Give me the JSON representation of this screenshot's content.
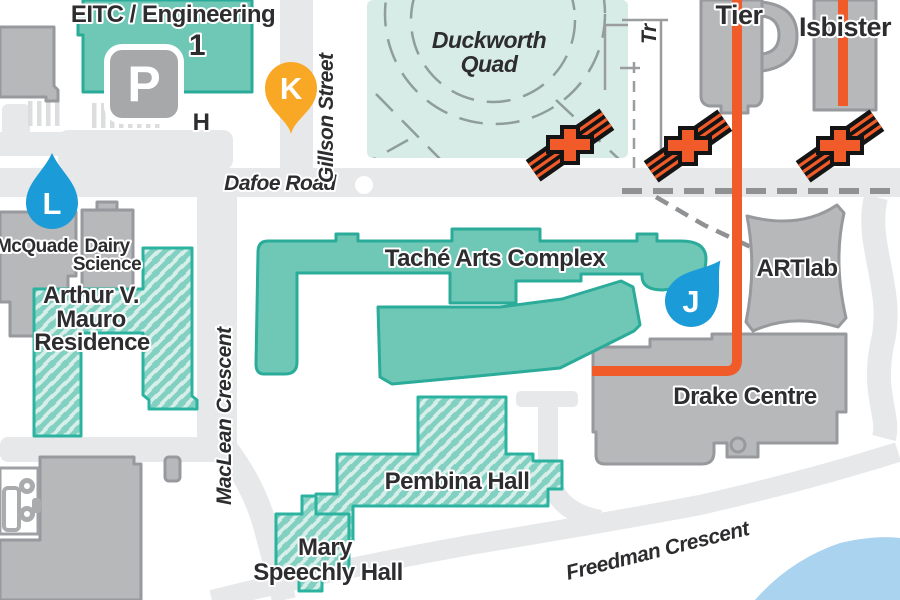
{
  "title": "Campus map",
  "colors": {
    "teal_fill": "#6FC8B6",
    "teal_stroke": "#2BAB99",
    "hatch_bg": "#D8EFE9",
    "hatch_stripe": "#82D0C2",
    "quad_fill": "#D8ECE7",
    "gray_building": "#B6B8BA",
    "gray_stroke": "#97999C",
    "road_gray": "#E7E8E9",
    "route_orange": "#F15A29",
    "pin_yellow": "#F9A825",
    "marker_blue": "#1B9BD8",
    "water_blue": "#A9D3EE",
    "label_dark": "#2D2D2F"
  },
  "buildings": {
    "eitc": {
      "name": "EITC / Engineering",
      "number": "1"
    },
    "tier": {
      "name": "Tier"
    },
    "isbister": {
      "name": "Isbister"
    },
    "mcquade": {
      "name": "McQuade"
    },
    "dairy_science": {
      "line1": "Dairy",
      "line2": "Science"
    },
    "mauro": {
      "line1": "Arthur V.",
      "line2": "Mauro",
      "line3": "Residence"
    },
    "tache": {
      "name": "Taché Arts Complex"
    },
    "artlab": {
      "name": "ARTlab"
    },
    "drake": {
      "name": "Drake Centre"
    },
    "pembina": {
      "name": "Pembina Hall"
    },
    "mary_speechly": {
      "line1": "Mary",
      "line2": "Speechly Hall"
    }
  },
  "open_space": {
    "duckworth": {
      "line1": "Duckworth",
      "line2": "Quad"
    }
  },
  "roads": {
    "dafoe": "Dafoe Road",
    "gillson": "Gillson Street",
    "maclean": "MacLean Crescent",
    "freedman": "Freedman Crescent",
    "partial_top": "Tr"
  },
  "markers": {
    "k": "K",
    "l": "L",
    "j": "J",
    "h": "H",
    "parking": "P"
  }
}
